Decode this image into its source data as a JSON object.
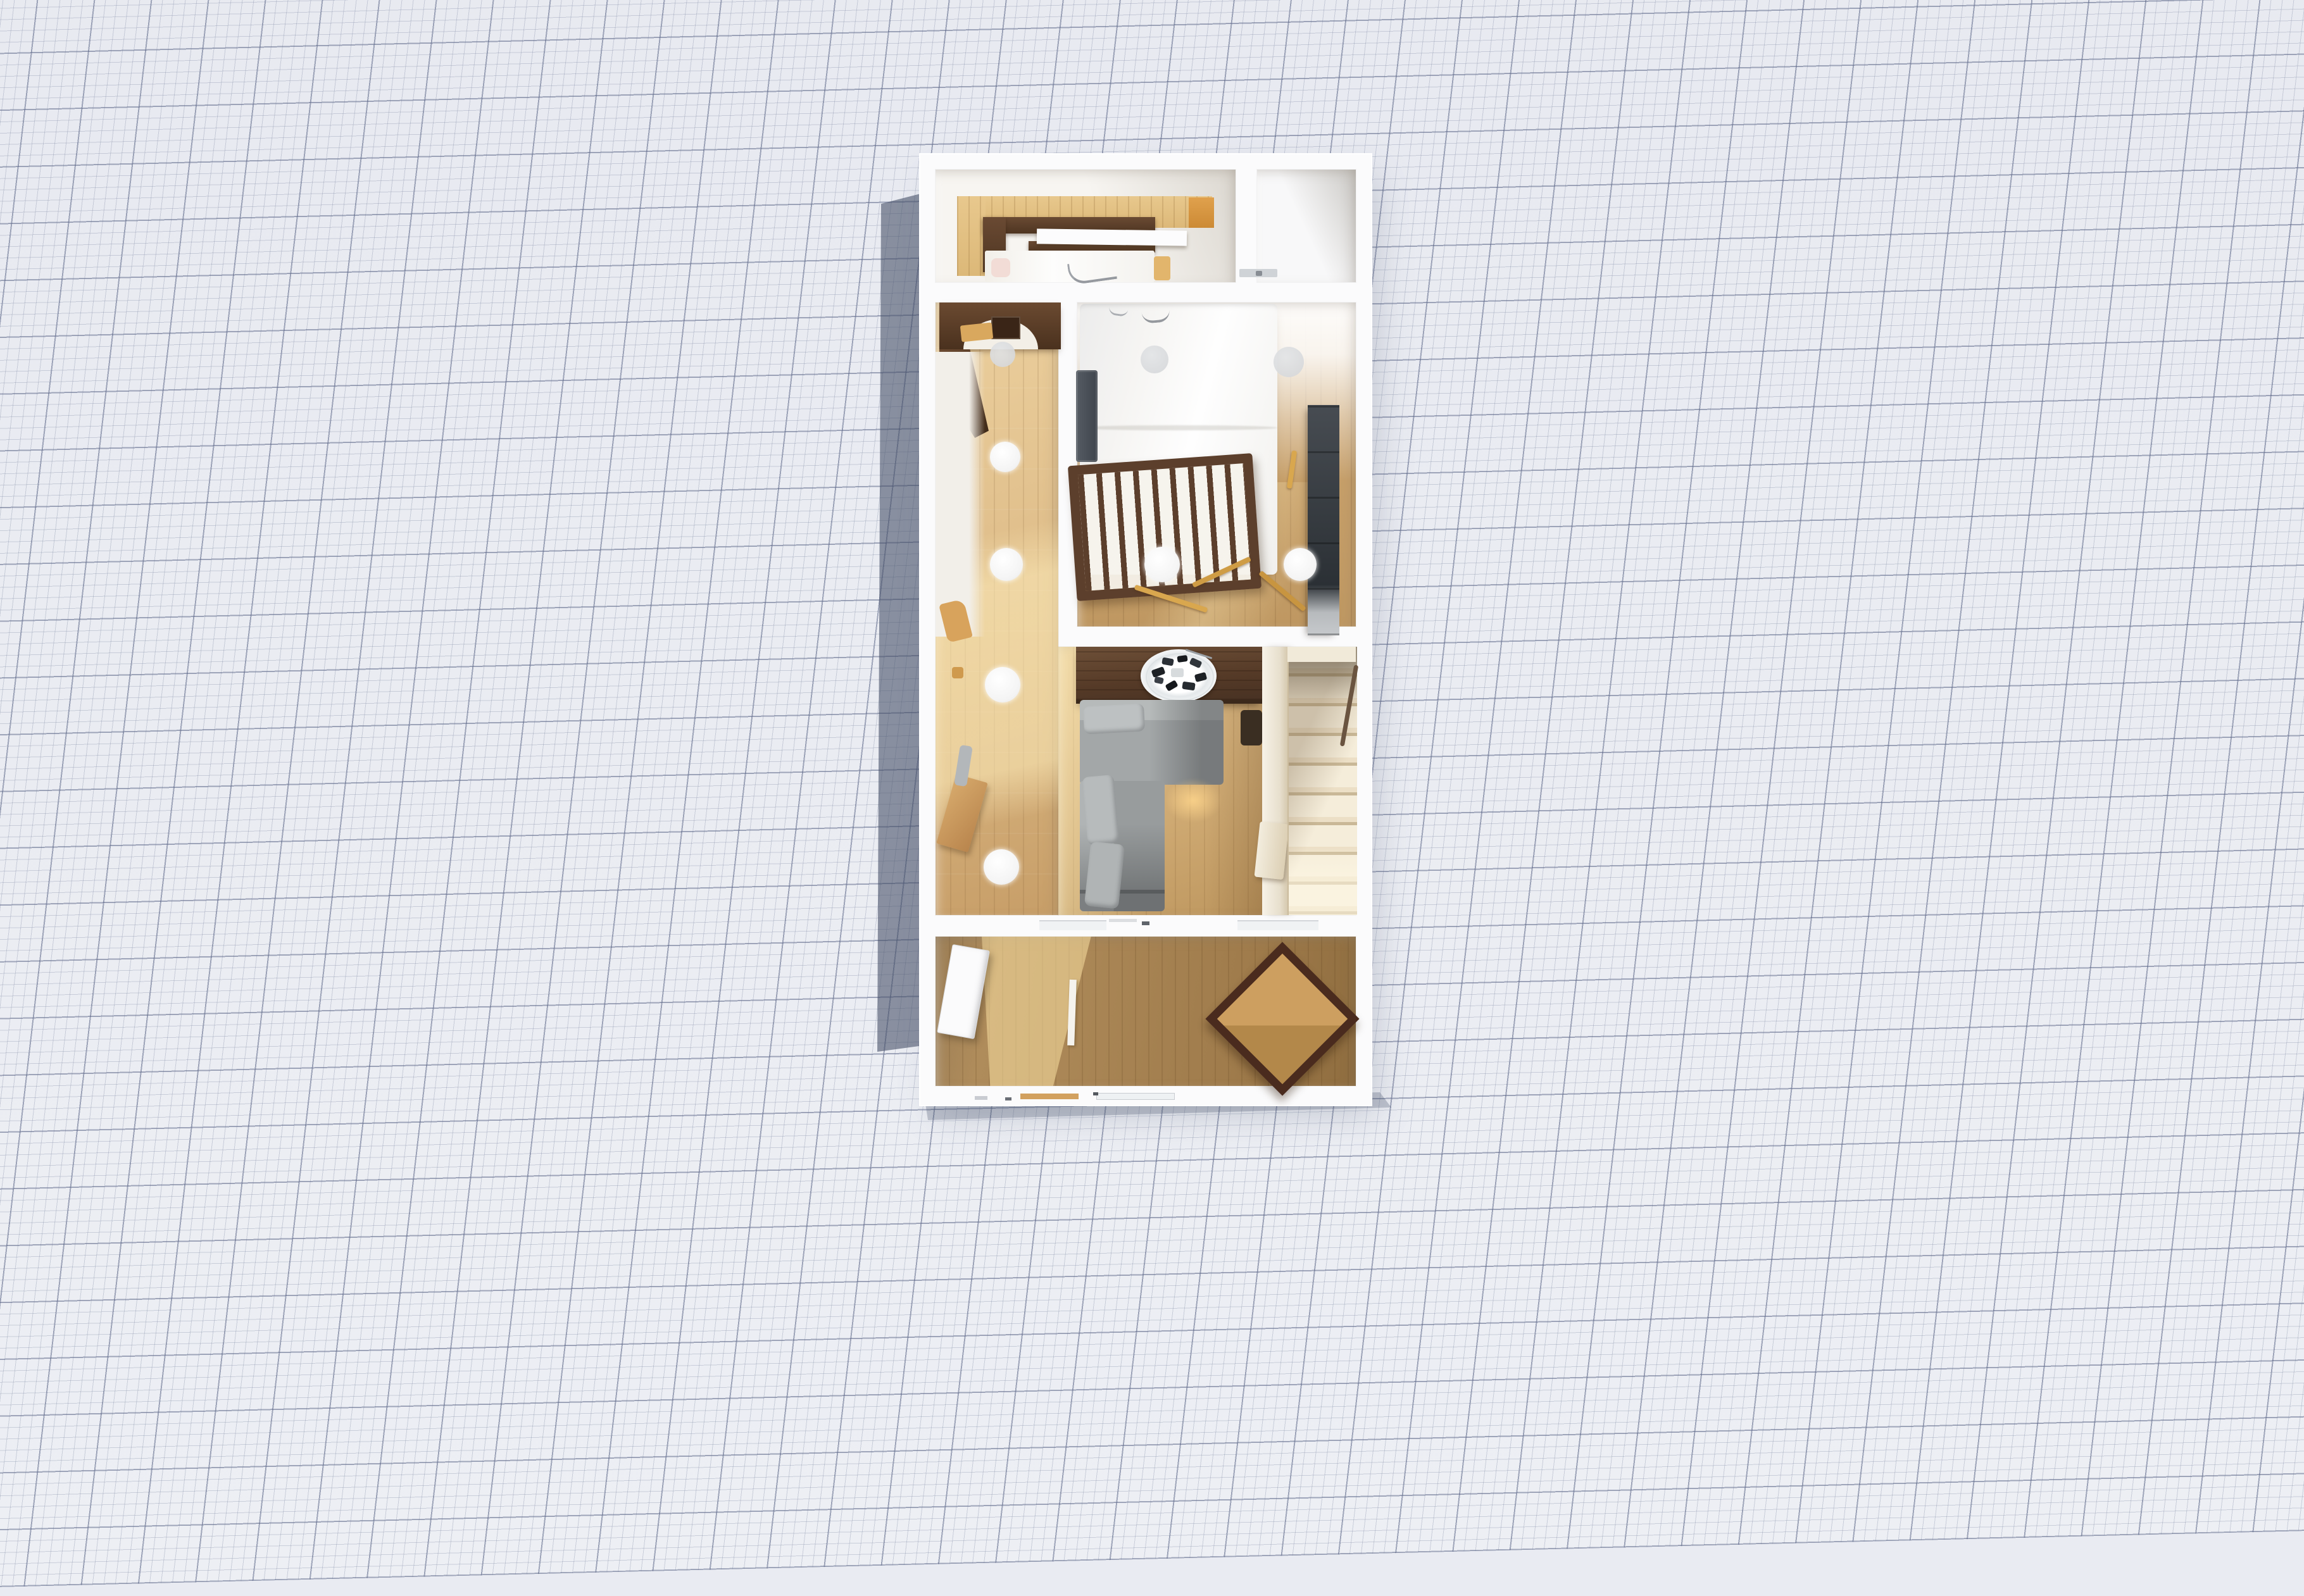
{
  "scene": {
    "title": "Top-down 3D floor plan render on graph paper",
    "building_label": "Narrow two-storey house — ground floor dollhouse view",
    "rooms": [
      {
        "id": "top-bedroom",
        "label": "Top bedroom with wood-panelled wall",
        "furniture": [
          "pine wall paneling",
          "walnut headboard unit",
          "white floating shelf",
          "bed with white duvet",
          "pink cushion",
          "gray ribbon decor",
          "tan cushion"
        ]
      },
      {
        "id": "closet",
        "label": "Closet / WC nook",
        "furniture": [
          "gray wall shelf"
        ]
      },
      {
        "id": "bedroom",
        "label": "Main bedroom",
        "furniture": [
          "double bed with white duvet",
          "dark ladder at bedside",
          "wooden crib with slats",
          "dark wardrobe",
          "wooden sticks on floor"
        ]
      },
      {
        "id": "hallway",
        "label": "Hallway",
        "furniture": [
          "dark wooden arch",
          "wall frame",
          "tan wall shelf",
          "side desk",
          "gray cloth",
          "tan basket"
        ]
      },
      {
        "id": "living-dining",
        "label": "Living / dining room",
        "furniture": [
          "walnut dining table",
          "round platter with sushi",
          "L-shaped gray sectional sofa",
          "staircase",
          "stair railing",
          "wall handrail"
        ]
      },
      {
        "id": "porch",
        "label": "Bottom room / porch",
        "furniture": [
          "leaning white door",
          "square table turned 45°",
          "loose white floor plank"
        ]
      }
    ],
    "ceiling_spotlights": {
      "white_count": 7,
      "dim_count": 3
    }
  },
  "colors": {
    "paper_bg": "#e9ebf2",
    "grid_minor": "rgba(128,138,164,0.33)",
    "grid_major": "rgba(98,108,140,0.5)",
    "cast_shadow": "rgba(66,76,100,0.58)",
    "wall": "#fbfbfc",
    "wood_hall": "#dcb985",
    "wood_bedroom": "#c7a06d",
    "wood_porch": "#a07c4c",
    "pine_panel": "#e3c185",
    "walnut": "#5b3f2b",
    "crib_wood": "#5c3f2c",
    "wardrobe": "#3c4146",
    "sofa_gray": "#a3a7a8",
    "stair_cream": "#efe6d2",
    "table_frame": "#4a2b1e",
    "table_top": "#c79a5c"
  }
}
